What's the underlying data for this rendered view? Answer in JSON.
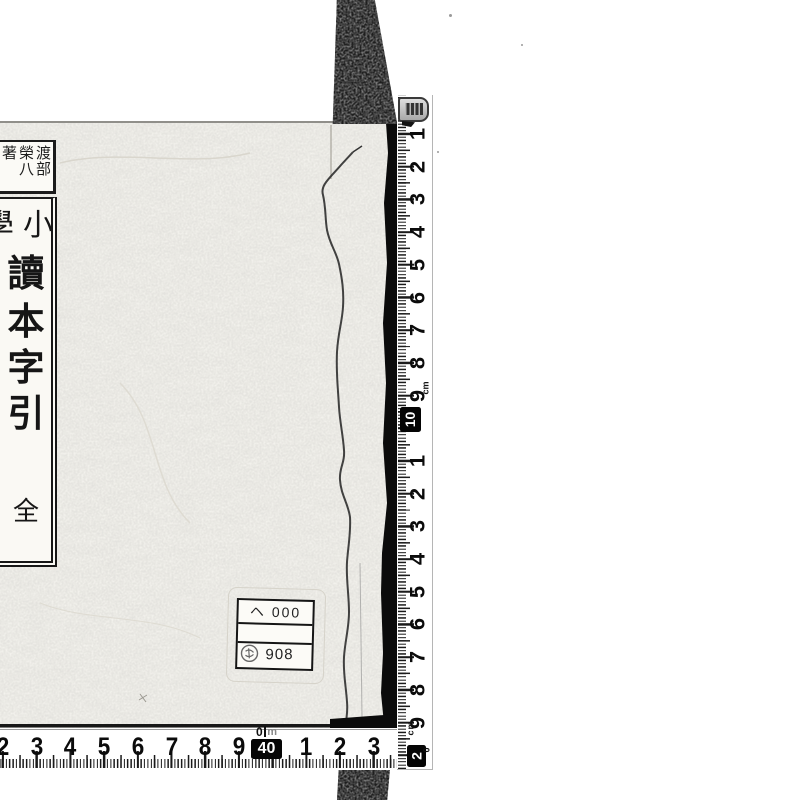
{
  "scan": {
    "book": {
      "author_label": {
        "columns": [
          "渡部",
          "榮八",
          "著"
        ]
      },
      "title_label": {
        "prefix_right": "小",
        "prefix_left": "學",
        "main_chars": [
          "讀",
          "本",
          "字",
          "引"
        ],
        "volume_char": "全"
      },
      "call_sticker": {
        "row1": "ヘ 000",
        "row2": "",
        "row3": "908"
      }
    },
    "vertical_ruler": {
      "numbers_1_9": [
        "1",
        "2",
        "3",
        "4",
        "5",
        "6",
        "7",
        "8",
        "9"
      ],
      "badge_10": "10",
      "numbers_11_19": [
        "1",
        "2",
        "3",
        "4",
        "5",
        "6",
        "7",
        "8",
        "9"
      ],
      "badge_20": "2",
      "badge_20_sup": "0",
      "unit": "cm"
    },
    "horizontal_ruler": {
      "numbers_left": [
        "2",
        "3",
        "4",
        "5",
        "6",
        "7",
        "8",
        "9"
      ],
      "badge_zero": "0",
      "badge_unit": "m",
      "badge_40": "40",
      "numbers_right": [
        "1",
        "2",
        "3",
        "4"
      ]
    }
  }
}
